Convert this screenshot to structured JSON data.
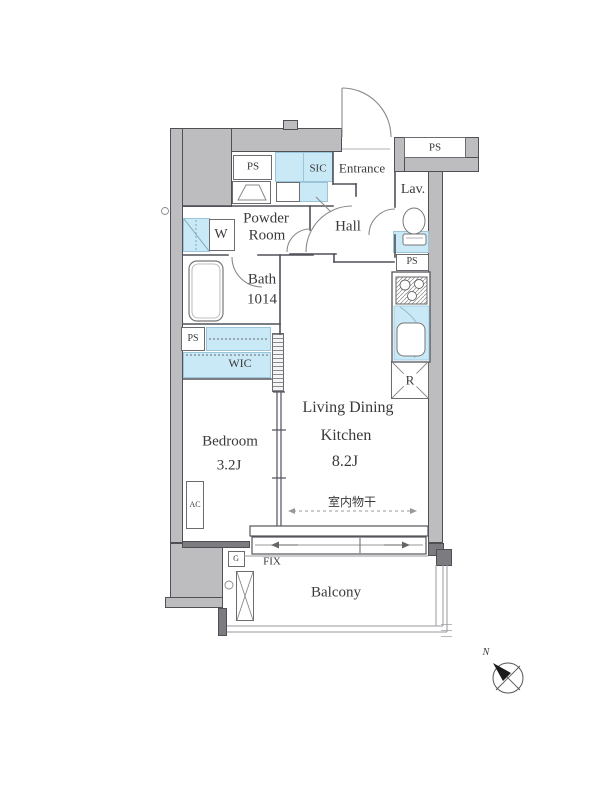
{
  "plan": {
    "rooms": {
      "entrance": "Entrance",
      "hall": "Hall",
      "lav": "Lav.",
      "powder_room": [
        "Powder",
        "Room"
      ],
      "bath": [
        "Bath",
        "1014"
      ],
      "wic": "WIC",
      "sic": "SIC",
      "bedroom": {
        "name": "Bedroom",
        "size": "3.2J"
      },
      "ldk": {
        "name1": "Living Dining",
        "name2": "Kitchen",
        "size": "8.2J"
      },
      "balcony": "Balcony"
    },
    "fixtures": {
      "ps": "PS",
      "w": "W",
      "r": "R",
      "ac": "AC",
      "g": "G",
      "fix": "FIX",
      "laundry_note": "室内物干",
      "compass_north": "N"
    },
    "colors": {
      "wall_fill": "#bdbdc0",
      "wall_dark": "#7b7b80",
      "wall_line": "#4f4f55",
      "fixture_blue": "#c9e9f6",
      "blue_border": "#9bc6da",
      "line": "#55555a",
      "thin_line": "#9a9a9e",
      "text": "#3a3a3a"
    }
  }
}
